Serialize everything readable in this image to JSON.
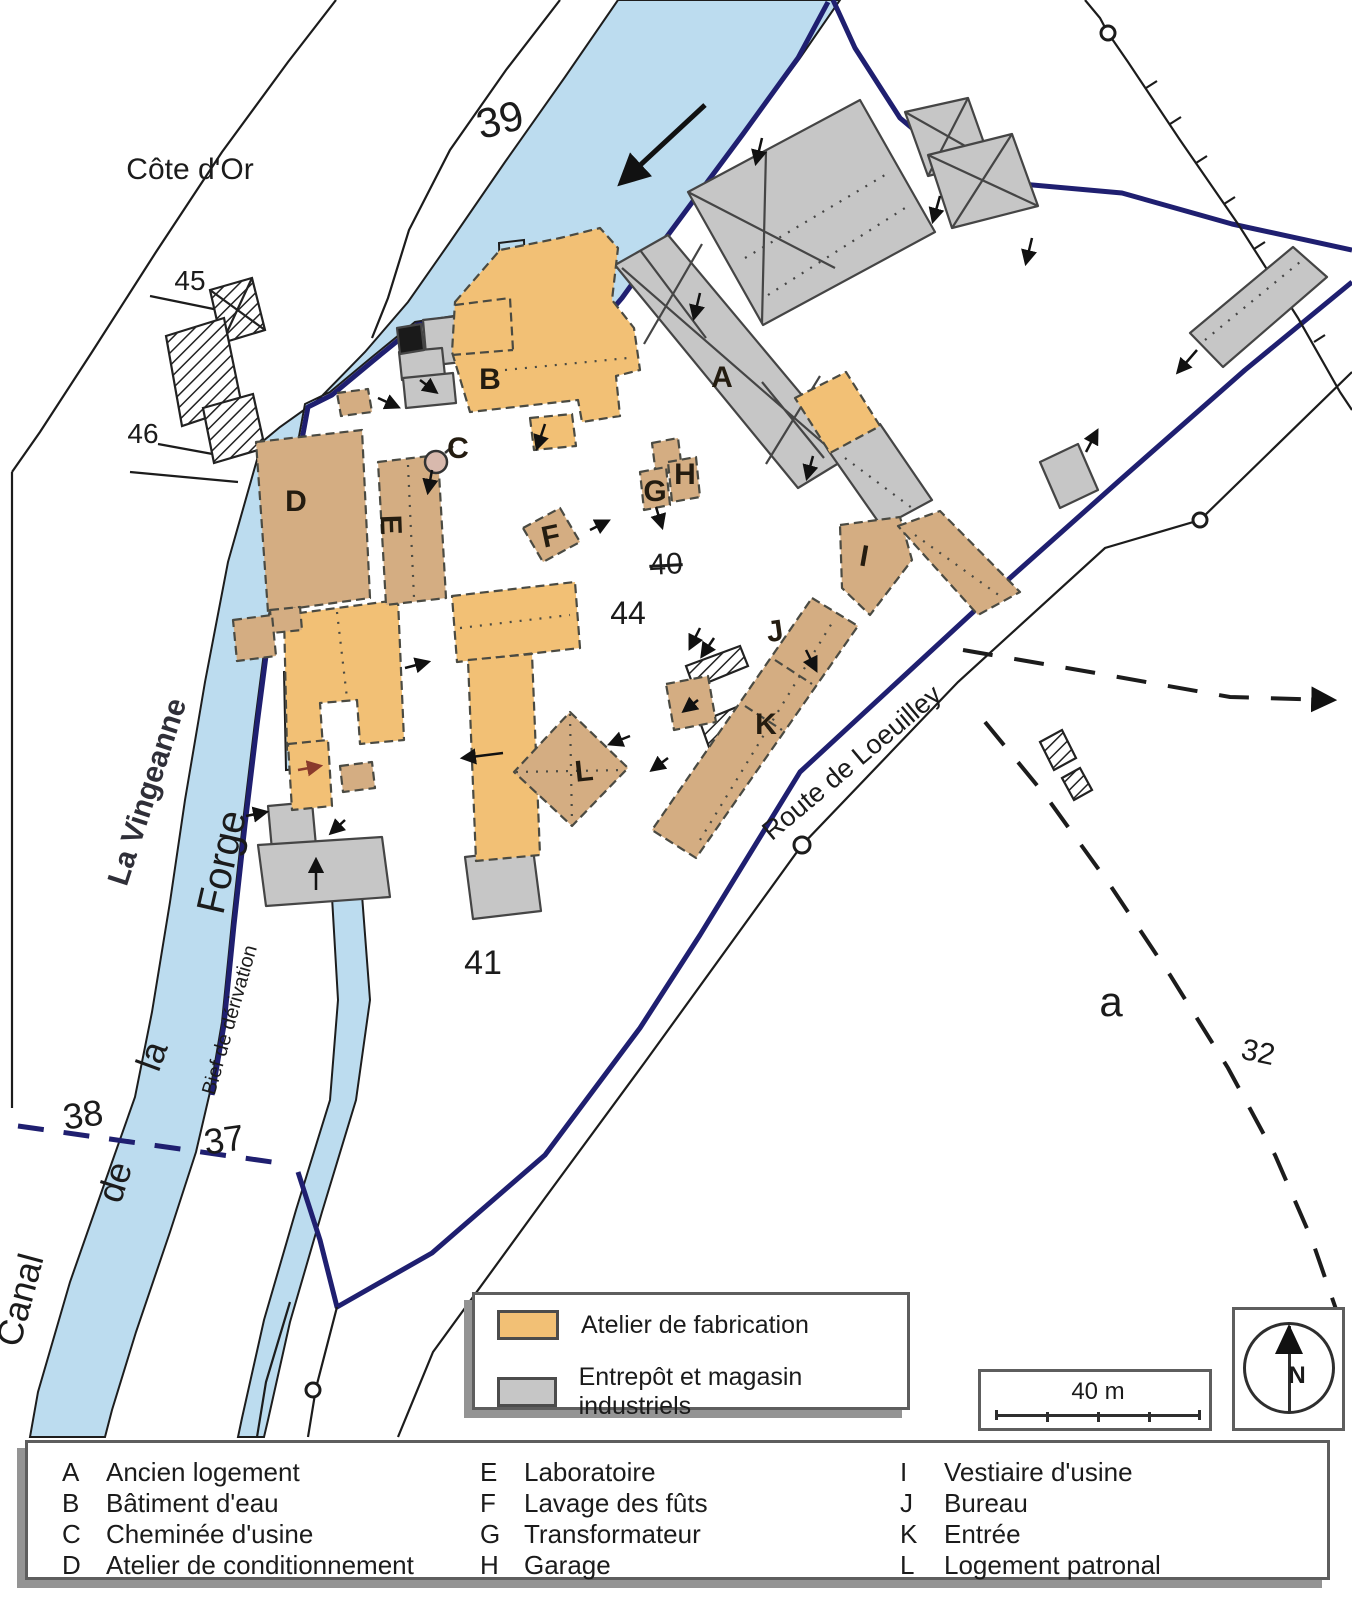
{
  "map": {
    "region_label": "Côte d'Or",
    "water": {
      "river_label": "La Vingeanne",
      "canal_label_words": {
        "w1": "Canal",
        "w2": "de",
        "w3": "la",
        "w4": "Forge"
      },
      "bief_label": "Bief de dérivation"
    },
    "road_label": "Route de Loeuilley",
    "parcel_labels": {
      "p39": "39",
      "p45": "45",
      "p46": "46",
      "p44": "44",
      "p40_struck": "40",
      "p41": "41",
      "p38": "38",
      "p37": "37",
      "p32": "32",
      "pa": "a"
    },
    "building_letters": {
      "A": "A",
      "B": "B",
      "C": "C",
      "D": "D",
      "E": "E",
      "F": "F",
      "G": "G",
      "H": "H",
      "I": "I",
      "J": "J",
      "K": "K",
      "L": "L"
    }
  },
  "legend": {
    "items": [
      {
        "label": "Atelier de fabrication",
        "color": "#f2c075"
      },
      {
        "label": "Entrepôt et magasin industriels",
        "color": "#c6c6c6"
      }
    ]
  },
  "scale_bar": {
    "label": "40 m"
  },
  "compass": {
    "label": "N"
  },
  "key": {
    "items": [
      {
        "letter": "A",
        "name": "Ancien logement"
      },
      {
        "letter": "B",
        "name": "Bâtiment d'eau"
      },
      {
        "letter": "C",
        "name": "Cheminée d'usine"
      },
      {
        "letter": "D",
        "name": "Atelier de conditionnement"
      },
      {
        "letter": "E",
        "name": "Laboratoire"
      },
      {
        "letter": "F",
        "name": "Lavage des fûts"
      },
      {
        "letter": "G",
        "name": "Transformateur"
      },
      {
        "letter": "H",
        "name": "Garage"
      },
      {
        "letter": "I",
        "name": "Vestiaire d'usine"
      },
      {
        "letter": "J",
        "name": "Bureau"
      },
      {
        "letter": "K",
        "name": "Entrée"
      },
      {
        "letter": "L",
        "name": "Logement patronal"
      }
    ]
  }
}
